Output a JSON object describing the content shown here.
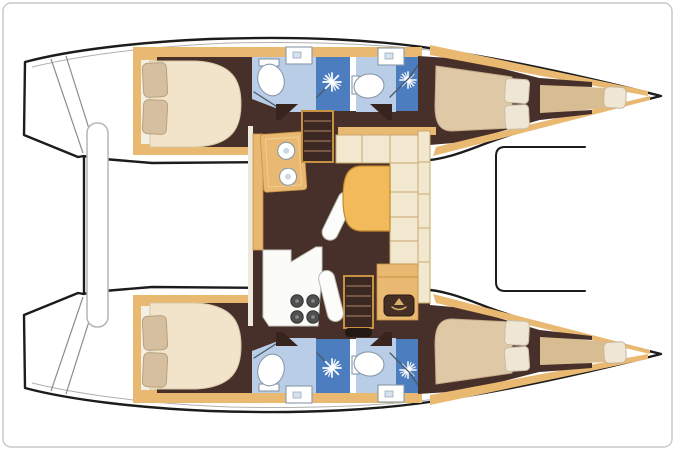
{
  "page": {
    "background": "#ffffff",
    "border_color": "#c9c9c9"
  },
  "diagram": {
    "type": "floor-plan",
    "subject": "catamaran-yacht-top-view",
    "orientation": "bows-right-sterns-left",
    "text_labels": [],
    "colors": {
      "outline": "#1c1c1c",
      "deck": "#ffffff",
      "trim": "#e9b871",
      "trimDark": "#c89243",
      "floor": "#48302a",
      "floorDark": "#38241e",
      "cream": "#f2e8cf",
      "creamLine": "#c9a76b",
      "mattress": "#f1e4ca",
      "mattressLine": "#d6c7a5",
      "pillow": "#d6bf9f",
      "pillowLine": "#b7a17e",
      "table": "#f3ba5c",
      "tableLine": "#c08a2e",
      "bathFloor": "#b9cde6",
      "shower": "#4c7dbf",
      "fixture": "#ffffff",
      "fixtureLine": "#8899aa",
      "grayLine": "#b0b0b0",
      "bunk": "#d9bd92"
    },
    "features": {
      "hulls": [
        {
          "name": "upper-hull",
          "rooms": [
            "aft-cabin-island-bed-two-pillows",
            "aft-head-toilet-sink",
            "aft-shower-stall",
            "forward-head-toilet-sink",
            "forward-shower-stall",
            "forward-cabin-double-berth-two-pillows",
            "forepeak-berth-with-pillow"
          ]
        },
        {
          "name": "lower-hull",
          "rooms": [
            "aft-cabin-island-bed-two-pillows",
            "aft-head-toilet-sink",
            "aft-shower-stall",
            "forward-head-toilet-sink",
            "forward-shower-stall",
            "forward-cabin-double-berth-two-pillows",
            "forepeak-berth-with-pillow"
          ]
        }
      ],
      "saloon": [
        "galley-sink-unit-two-basins",
        "galley-counter",
        "stove-four-burner",
        "refrigerator",
        "l-shaped-sofa",
        "dining-table",
        "companionway-stairs-upper",
        "companionway-stairs-lower",
        "cabinet-with-emblem",
        "seat-bench-upper",
        "seat-bench-lower"
      ],
      "exterior": [
        "transom-steps-left",
        "aft-platform-beam",
        "forward-crossbeam-bracket",
        "bow-tips-right"
      ]
    }
  }
}
